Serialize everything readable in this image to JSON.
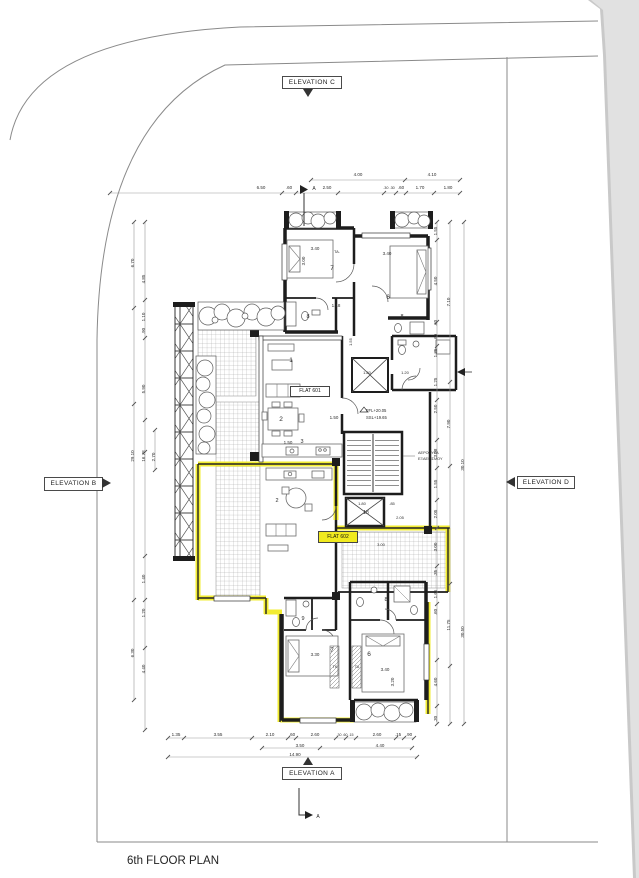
{
  "page": {
    "title": "6th FLOOR PLAN"
  },
  "colors": {
    "paper": "#ffffff",
    "scan_background": "#e1e1e1",
    "wall": "#1d1d1d",
    "dimension_line": "#9a9a9a",
    "highlight": "#f1ea1f"
  },
  "elevation_labels": {
    "a": "ELEVATION A",
    "b": "ELEVATION B",
    "c": "ELEVATION C",
    "d": "ELEVATION D"
  },
  "flat_labels": {
    "flat_601": "FLAT 601",
    "flat_602": "FLAT 602"
  },
  "level_labels": {
    "ffl": "FFL+20.05",
    "ssl": "SSL+19.65"
  },
  "shaft_note": {
    "line1": "ΑΕΡΟΘΥΡΑ",
    "line2": "ΕΞΑΕΡΙΣΜΟΥ"
  },
  "annotations": [
    {
      "t": "4.00",
      "x": 358,
      "y": 176
    },
    {
      "t": "4.10",
      "x": 432,
      "y": 176
    },
    {
      "t": "6.50",
      "x": 261,
      "y": 189
    },
    {
      "t": ".60",
      "x": 289,
      "y": 189
    },
    {
      "t": "A",
      "x": 314,
      "y": 190,
      "s": 5,
      "n": "section-marker-label"
    },
    {
      "t": "2.50",
      "x": 327,
      "y": 189
    },
    {
      "t": ".30 .30",
      "x": 389,
      "y": 189,
      "s": 3.8
    },
    {
      "t": ".60",
      "x": 401,
      "y": 189
    },
    {
      "t": "1.70",
      "x": 420,
      "y": 189
    },
    {
      "t": "1.80",
      "x": 448,
      "y": 189
    },
    {
      "t": "1.55",
      "x": 437,
      "y": 231,
      "r": -90
    },
    {
      "t": "4.50",
      "x": 437,
      "y": 281,
      "r": -90
    },
    {
      "t": ".60",
      "x": 437,
      "y": 323,
      "r": -90
    },
    {
      "t": ".60",
      "x": 437,
      "y": 337,
      "r": -90
    },
    {
      "t": "1.35",
      "x": 437,
      "y": 353,
      "r": -90
    },
    {
      "t": "1.25",
      "x": 437,
      "y": 382,
      "r": -90
    },
    {
      "t": "2.50",
      "x": 437,
      "y": 409,
      "r": -90
    },
    {
      "t": "3.08",
      "x": 437,
      "y": 453,
      "r": -90
    },
    {
      "t": "1.55",
      "x": 437,
      "y": 484,
      "r": -90
    },
    {
      "t": "2.05",
      "x": 437,
      "y": 514,
      "r": -90
    },
    {
      "t": "3.00",
      "x": 437,
      "y": 547,
      "r": -90
    },
    {
      "t": ".35",
      "x": 437,
      "y": 573,
      "r": -90
    },
    {
      "t": "1.65",
      "x": 437,
      "y": 594,
      "r": -90
    },
    {
      "t": ".60",
      "x": 437,
      "y": 612,
      "r": -90
    },
    {
      "t": "4.60",
      "x": 437,
      "y": 682,
      "r": -90
    },
    {
      "t": ".30",
      "x": 437,
      "y": 719,
      "r": -90
    },
    {
      "t": "7.10",
      "x": 450,
      "y": 302,
      "r": -90
    },
    {
      "t": "7.90",
      "x": 450,
      "y": 424,
      "r": -90
    },
    {
      "t": "11.75",
      "x": 450,
      "y": 625,
      "r": -90
    },
    {
      "t": "30.10",
      "x": 464,
      "y": 465,
      "r": -90
    },
    {
      "t": "30.50",
      "x": 464,
      "y": 632,
      "r": -90
    },
    {
      "t": "6.70",
      "x": 134,
      "y": 263,
      "r": -90
    },
    {
      "t": "29.10",
      "x": 134,
      "y": 456,
      "r": -90
    },
    {
      "t": "6.30",
      "x": 134,
      "y": 653,
      "r": -90
    },
    {
      "t": "4.85",
      "x": 145,
      "y": 279,
      "r": -90
    },
    {
      "t": "1.10",
      "x": 145,
      "y": 317,
      "r": -90
    },
    {
      "t": ".90",
      "x": 145,
      "y": 331,
      "r": -90
    },
    {
      "t": "5.90",
      "x": 145,
      "y": 389,
      "r": -90
    },
    {
      "t": "16.78",
      "x": 145,
      "y": 456,
      "r": -90
    },
    {
      "t": "1.40",
      "x": 145,
      "y": 579,
      "r": -90
    },
    {
      "t": "1.20",
      "x": 145,
      "y": 613,
      "r": -90
    },
    {
      "t": "4.40",
      "x": 145,
      "y": 669,
      "r": -90
    },
    {
      "t": "2.70",
      "x": 155,
      "y": 457,
      "r": -90
    },
    {
      "t": "1.35",
      "x": 176,
      "y": 736
    },
    {
      "t": "3.55",
      "x": 218,
      "y": 736
    },
    {
      "t": "2.10",
      "x": 270,
      "y": 736
    },
    {
      "t": ".60",
      "x": 292,
      "y": 736
    },
    {
      "t": "2.60",
      "x": 315,
      "y": 736
    },
    {
      "t": ".30 .60 .15",
      "x": 345,
      "y": 736,
      "s": 3.6
    },
    {
      "t": "2.60",
      "x": 377,
      "y": 736
    },
    {
      "t": ".15",
      "x": 398,
      "y": 736
    },
    {
      "t": ".90",
      "x": 409,
      "y": 736
    },
    {
      "t": "3.50",
      "x": 300,
      "y": 747
    },
    {
      "t": "4.40",
      "x": 380,
      "y": 747
    },
    {
      "t": "14.90",
      "x": 295,
      "y": 756
    },
    {
      "t": "3.40",
      "x": 315,
      "y": 250
    },
    {
      "t": "3.00",
      "x": 305,
      "y": 261,
      "r": -90
    },
    {
      "t": "3.40",
      "x": 387,
      "y": 255
    },
    {
      "t": "TA.",
      "x": 337,
      "y": 253,
      "s": 4,
      "n": "closet-label"
    },
    {
      "t": "7",
      "x": 332,
      "y": 270,
      "s": 6.5,
      "n": "room-number"
    },
    {
      "t": "6",
      "x": 388,
      "y": 299,
      "s": 6.5,
      "n": "room-number"
    },
    {
      "t": "8",
      "x": 308,
      "y": 318,
      "s": 5.5,
      "n": "room-number"
    },
    {
      "t": "8",
      "x": 402,
      "y": 318,
      "s": 5.5,
      "n": "room-number"
    },
    {
      "t": "1.18",
      "x": 336,
      "y": 307
    },
    {
      "t": "1",
      "x": 291,
      "y": 362,
      "s": 6.5,
      "n": "room-number"
    },
    {
      "t": "2",
      "x": 281,
      "y": 421,
      "s": 6.5,
      "n": "room-number"
    },
    {
      "t": "1.50",
      "x": 288,
      "y": 444
    },
    {
      "t": "3",
      "x": 302,
      "y": 443,
      "s": 5.5,
      "n": "room-number"
    },
    {
      "t": "1.50",
      "x": 334,
      "y": 419
    },
    {
      "t": "1.55",
      "x": 352,
      "y": 342,
      "r": -90,
      "s": 4
    },
    {
      "t": "1.80",
      "x": 367,
      "y": 374,
      "s": 4
    },
    {
      "t": "1.20",
      "x": 405,
      "y": 374,
      "s": 4
    },
    {
      "t": "18",
      "x": 366,
      "y": 514,
      "s": 5,
      "n": "room-number"
    },
    {
      "t": "1.80",
      "x": 362,
      "y": 505,
      "s": 4
    },
    {
      "t": ".85",
      "x": 392,
      "y": 505,
      "s": 4
    },
    {
      "t": "2.05",
      "x": 400,
      "y": 519,
      "s": 4
    },
    {
      "t": "3.00",
      "x": 381,
      "y": 546,
      "s": 4
    },
    {
      "t": "2",
      "x": 277,
      "y": 502,
      "s": 5.5,
      "n": "room-number"
    },
    {
      "t": "9",
      "x": 303,
      "y": 620,
      "s": 5.5,
      "n": "room-number"
    },
    {
      "t": "8",
      "x": 386,
      "y": 601,
      "s": 5.5,
      "n": "room-number"
    },
    {
      "t": "7",
      "x": 332,
      "y": 652,
      "s": 6.5,
      "n": "room-number"
    },
    {
      "t": "6",
      "x": 369,
      "y": 656,
      "s": 6.5,
      "n": "room-number"
    },
    {
      "t": "3.30",
      "x": 315,
      "y": 656
    },
    {
      "t": "3.40",
      "x": 385,
      "y": 671
    },
    {
      "t": "3.20",
      "x": 394,
      "y": 682,
      "r": -90
    },
    {
      "t": "TK",
      "x": 335,
      "y": 668,
      "s": 3.8,
      "n": "closet-label"
    },
    {
      "t": "TA",
      "x": 357,
      "y": 668,
      "s": 3.8,
      "n": "closet-label"
    },
    {
      "t": "A",
      "x": 318,
      "y": 818,
      "s": 5,
      "n": "section-marker-label"
    }
  ]
}
